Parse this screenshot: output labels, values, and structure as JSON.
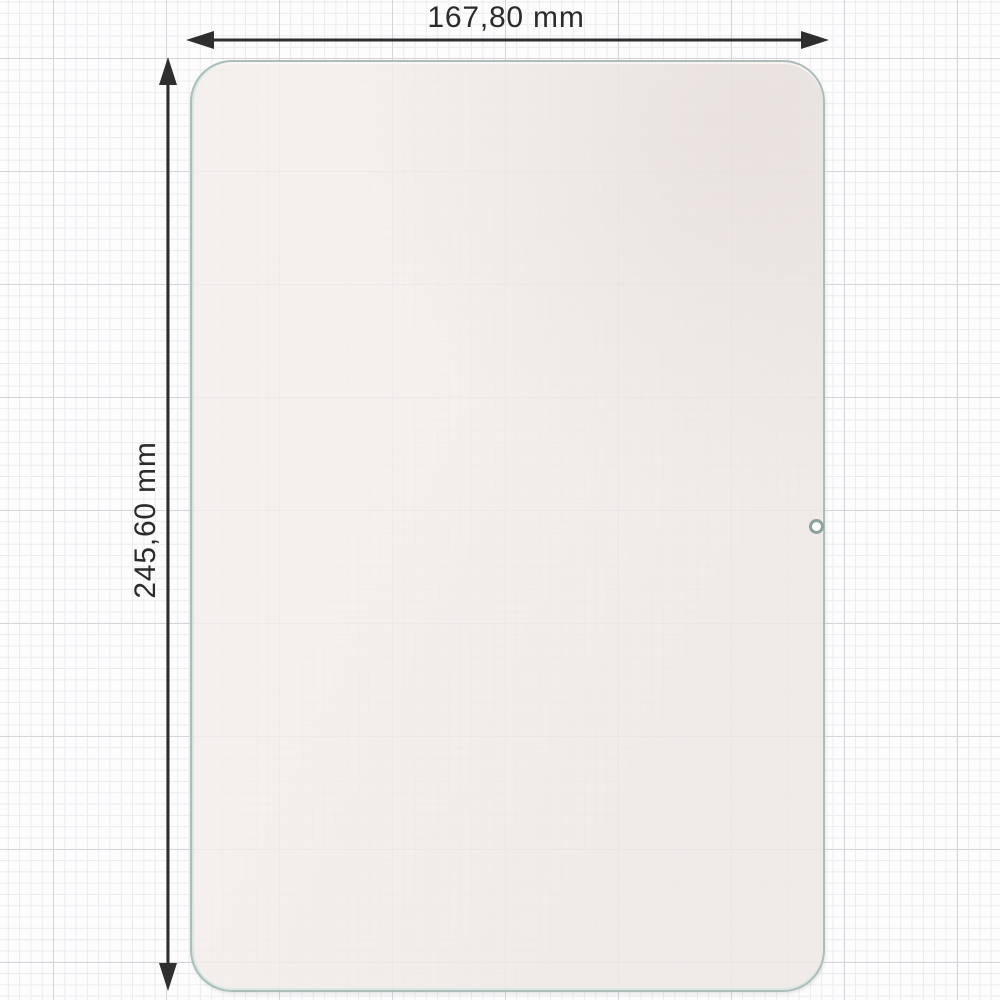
{
  "diagram": {
    "type": "product-dimension-diagram",
    "subject": "tablet screen protector",
    "dimensions": {
      "width": {
        "value": "167,80",
        "unit": "mm",
        "label": "167,80 mm"
      },
      "height": {
        "value": "245,60",
        "unit": "mm",
        "label": "245,60 mm"
      }
    },
    "icons": {
      "camera_hole": "circle-cutout"
    }
  },
  "colors": {
    "background": "#fdfdfd",
    "grid_minor": "#ecebf0",
    "grid_major": "#d6d5db",
    "dimension_line": "#2e2e2e",
    "label_text": "#2b2b2b",
    "protector_outline": "#adbdba",
    "protector_fill": "#f3eeeb",
    "camera_ring": "#8da19d"
  }
}
